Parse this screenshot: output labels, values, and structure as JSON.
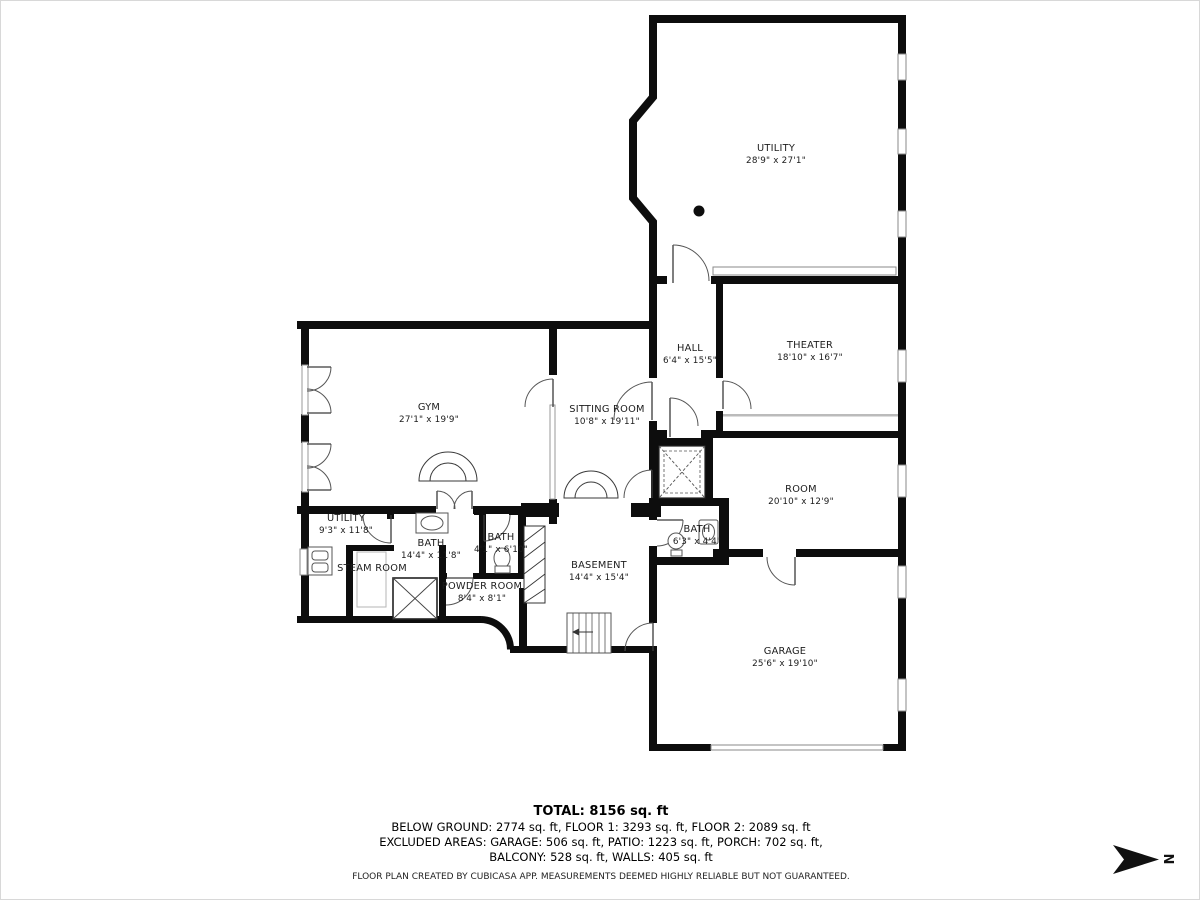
{
  "floor_plan": {
    "creator": "CubiCasa",
    "rooms": [
      {
        "name": "UTILITY",
        "dims": "28'9\" x 27'1\"",
        "x": 775,
        "y": 150
      },
      {
        "name": "HALL",
        "dims": "6'4\" x 15'5\"",
        "x": 689,
        "y": 350
      },
      {
        "name": "THEATER",
        "dims": "18'10\" x 16'7\"",
        "x": 809,
        "y": 347
      },
      {
        "name": "GYM",
        "dims": "27'1\" x 19'9\"",
        "x": 428,
        "y": 409
      },
      {
        "name": "SITTING ROOM",
        "dims": "10'8\" x 19'11\"",
        "x": 606,
        "y": 411
      },
      {
        "name": "ROOM",
        "dims": "20'10\" x 12'9\"",
        "x": 800,
        "y": 491
      },
      {
        "name": "UTILITY",
        "dims": "9'3\" x 11'8\"",
        "x": 345,
        "y": 520
      },
      {
        "name": "BATH",
        "dims": "14'4\" x 11'8\"",
        "x": 430,
        "y": 545
      },
      {
        "name": "BATH",
        "dims": "4'1\" x 6'10\"",
        "x": 500,
        "y": 539
      },
      {
        "name": "STEAM ROOM",
        "dims": "",
        "x": 371,
        "y": 570
      },
      {
        "name": "POWDER ROOM",
        "dims": "8'4\" x 8'1\"",
        "x": 481,
        "y": 588
      },
      {
        "name": "BASEMENT",
        "dims": "14'4\" x 15'4\"",
        "x": 598,
        "y": 567
      },
      {
        "name": "BATH",
        "dims": "6'3\" x 4'4\"",
        "x": 696,
        "y": 531
      },
      {
        "name": "GARAGE",
        "dims": "25'6\" x 19'10\"",
        "x": 784,
        "y": 653
      }
    ]
  },
  "footer": {
    "total": "TOTAL: 8156 sq. ft",
    "line2": "BELOW GROUND: 2774 sq. ft, FLOOR 1: 3293 sq. ft, FLOOR 2: 2089 sq. ft",
    "line3": "EXCLUDED AREAS: GARAGE: 506 sq. ft, PATIO: 1223 sq. ft, PORCH: 702 sq. ft,",
    "line4": "BALCONY: 528 sq. ft, WALLS: 405 sq. ft",
    "disclaimer": "FLOOR PLAN CREATED BY CUBICASA APP. MEASUREMENTS DEEMED HIGHLY RELIABLE BUT NOT GUARANTEED."
  },
  "compass": {
    "label": "N"
  }
}
